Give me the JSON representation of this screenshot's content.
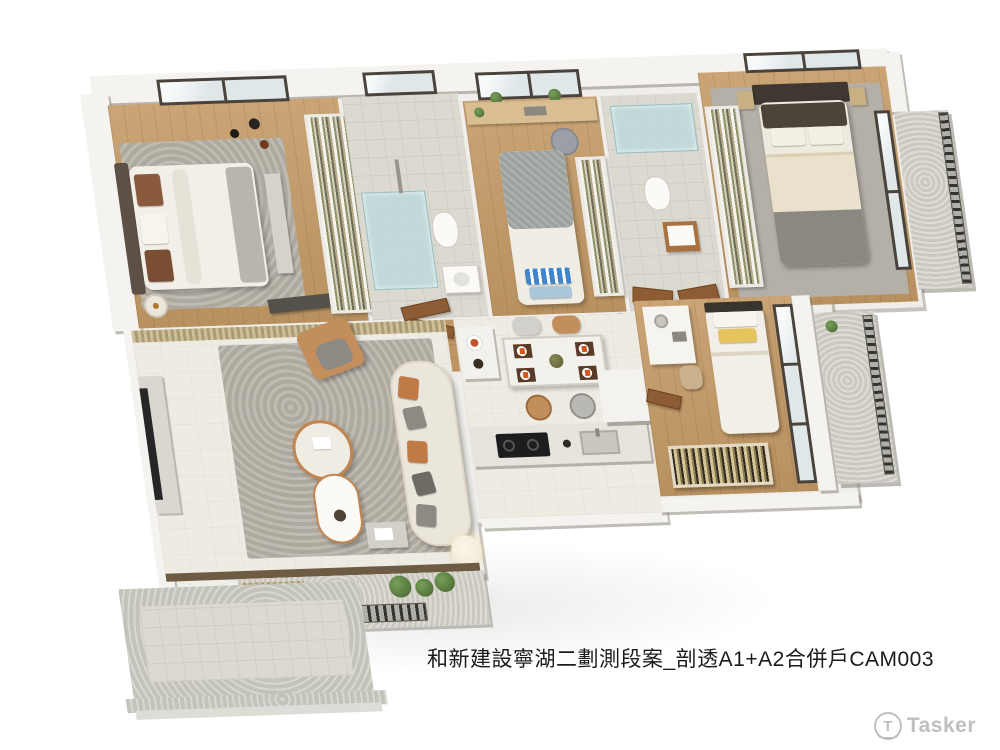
{
  "caption": {
    "text": "和新建設寧湖二劃測段案_剖透A1+A2合併戶CAM003"
  },
  "watermark": {
    "text": "Tasker",
    "icon": "tasker-circle-t-logo",
    "color": "#bfbfc2"
  },
  "scene": {
    "type": "3d-axonometric-cutaway-floorplan-render",
    "project": "和新建設寧湖二劃測段案",
    "view": "剖透A1+A2合併戶",
    "camera": "CAM003",
    "rooms": [
      {
        "name": "secondary-bedroom-left",
        "floor": "wood",
        "furniture": [
          "double-bed-white-duvet-brown-pillows",
          "leather-wing-headboard",
          "foot-bench",
          "open-wardrobe-shelving",
          "floor-lamp",
          "pendant-lamp",
          "window",
          "gray-rug"
        ]
      },
      {
        "name": "bathroom-1",
        "floor": "light-tile",
        "furniture": [
          "glass-shower",
          "toilet",
          "washbasin",
          "window",
          "wood-door"
        ]
      },
      {
        "name": "kids-bedroom",
        "floor": "wood",
        "furniture": [
          "single-bed-gray-blanket",
          "blue-striped-pillow",
          "desk",
          "gray-desk-chair",
          "window-with-plants",
          "open-wardrobe"
        ]
      },
      {
        "name": "bathroom-2",
        "floor": "light-tile",
        "furniture": [
          "glass-tub",
          "toilet",
          "washbasin-wood-cabinet",
          "double-wood-doors"
        ]
      },
      {
        "name": "master-bedroom",
        "floor": "carpet-over-wood",
        "furniture": [
          "double-bed-dark-headboard-cream-duvet",
          "dark-pillows",
          "nightstands-with-lamps",
          "open-wardrobe",
          "windows",
          "private-balcony-railing"
        ]
      },
      {
        "name": "small-bedroom-right",
        "floor": "wood",
        "furniture": [
          "single-bed-yellow-pillow",
          "vanity-desk",
          "chair",
          "clothes-rack",
          "full-height-window",
          "balcony-railing",
          "wood-door"
        ]
      },
      {
        "name": "living-room",
        "floor": "cream-tile",
        "furniture": [
          "curved-cream-sofa",
          "orange-and-gray-pillows",
          "tan-armchair-with-throw",
          "round-nesting-coffee-tables",
          "textured-gray-rug",
          "tv-console",
          "tv",
          "floor-lamp",
          "side-table",
          "wood-slat-partition"
        ]
      },
      {
        "name": "dining-area",
        "floor": "cream-tile",
        "furniture": [
          "marble-dining-table",
          "four-place-settings-orange-napkins",
          "centerpiece-plant",
          "tan-chair",
          "gray-chair",
          "tan-stool",
          "gray-stool",
          "service-island"
        ]
      },
      {
        "name": "kitchen",
        "floor": "cream-tile",
        "furniture": [
          "counter",
          "black-cooktop",
          "sink",
          "refrigerator"
        ]
      },
      {
        "name": "entry-hall",
        "floor": "wood",
        "furniture": [
          "shoe-cabinet",
          "wood-door"
        ]
      },
      {
        "name": "terrace",
        "floor": "stone-tile",
        "furniture": [
          "planter-boxes-greenery",
          "fence-posts",
          "sunken-tiled-patio",
          "steps"
        ]
      }
    ]
  },
  "palette": {
    "background": "#ffffff",
    "caption_text": "#1b1b1b",
    "watermark_gray": "#bfbfc2",
    "wall_white": "#f4f3ef",
    "wall_shadow": "#b4b0a8",
    "wood_floor": "#c49a66",
    "cream_tile": "#eeebe3",
    "bath_tile": "#dcd9d1",
    "rug_gray": "#b6b1a8",
    "glass_blue": "#bcd8da",
    "window_frame": "#4a433c",
    "door_wood": "#8e5c34",
    "sofa_cream": "#ebe6dc",
    "accent_orange": "#c07a45",
    "accent_yellow": "#e5c45e",
    "accent_blue": "#4a8ec6",
    "plant_green": "#55783e",
    "headboard_dark": "#3e3831",
    "duvet_cream": "#e9e1cb"
  }
}
